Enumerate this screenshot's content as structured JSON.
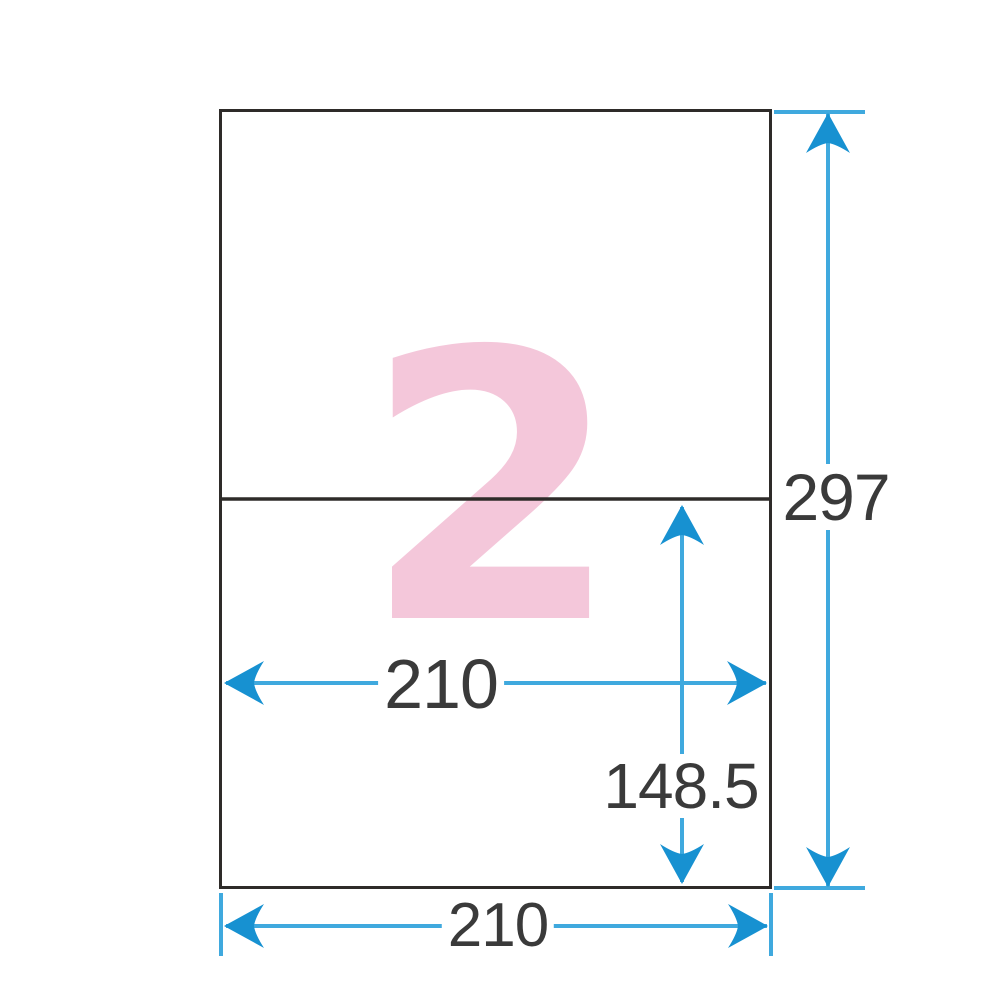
{
  "diagram": {
    "label_count": "2",
    "dimensions": {
      "sheet_height": "297",
      "sheet_width": "210",
      "label_width": "210",
      "label_height": "148.5"
    },
    "colors": {
      "dimension_line_blue": "#3fa9de",
      "arrowhead_blue": "#1791d1",
      "outline_dark": "#2e2b29",
      "label_count_pink": "#f4c7da",
      "dimension_text": "#3a3a3a",
      "sheet_fill": "#ffffff"
    }
  }
}
